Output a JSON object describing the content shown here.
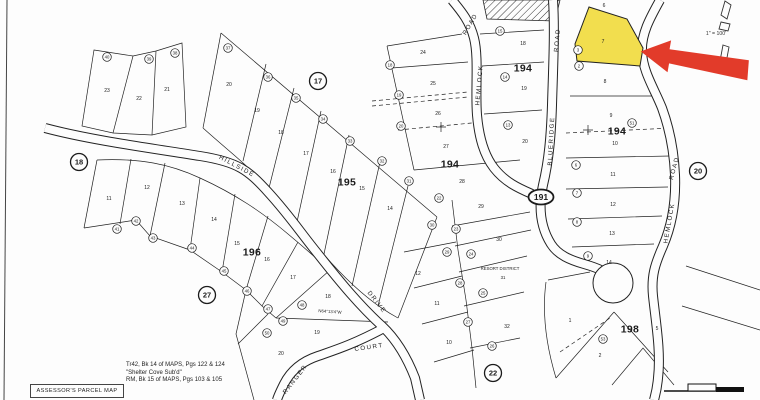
{
  "map": {
    "title": "ASSESSOR'S PARCEL MAP",
    "notes": [
      "Tr42, Bk 14 of MAPS, Pgs 122 & 124",
      "\"Shelter Cove Sub'd\"",
      "RM, Bk 15 of MAPS, Pgs 103 & 105"
    ],
    "scale_label": "1\" = 100'",
    "paper_color": "#fdfdfd",
    "ink_color": "#1b1b1b",
    "highlight": {
      "lot": "7",
      "fill": "#F2DE4E",
      "arrow_color": "#E23B2A"
    },
    "highway_shield": {
      "label": "191",
      "x": 541,
      "y": 197
    },
    "page_circles": [
      {
        "t": "17",
        "x": 318,
        "y": 81
      },
      {
        "t": "18",
        "x": 79,
        "y": 162
      },
      {
        "t": "27",
        "x": 207,
        "y": 295
      },
      {
        "t": "20",
        "x": 698,
        "y": 171
      },
      {
        "t": "22",
        "x": 493,
        "y": 373
      }
    ],
    "blocks": [
      {
        "t": "194",
        "x": 450,
        "y": 164
      },
      {
        "t": "194",
        "x": 523,
        "y": 68
      },
      {
        "t": "194",
        "x": 617,
        "y": 131
      },
      {
        "t": "195",
        "x": 347,
        "y": 182
      },
      {
        "t": "196",
        "x": 252,
        "y": 252
      },
      {
        "t": "198",
        "x": 630,
        "y": 329
      }
    ],
    "roads": [
      {
        "t": "HILLSIDE",
        "x": 237,
        "y": 166,
        "r": 28
      },
      {
        "t": "DRIVE",
        "x": 377,
        "y": 302,
        "r": 52
      },
      {
        "t": "COURT",
        "x": 369,
        "y": 347,
        "r": -8
      },
      {
        "t": "RANGER",
        "x": 295,
        "y": 379,
        "r": -52
      },
      {
        "t": "HEMLOCK",
        "x": 479,
        "y": 85,
        "r": -85
      },
      {
        "t": "ROAD",
        "x": 470,
        "y": 24,
        "r": -60
      },
      {
        "t": "BLUERIDGE",
        "x": 551,
        "y": 141,
        "r": -87
      },
      {
        "t": "ROAD",
        "x": 557,
        "y": 40,
        "r": -85
      },
      {
        "t": "HEMLOCK",
        "x": 669,
        "y": 223,
        "r": -80
      },
      {
        "t": "ROAD",
        "x": 674,
        "y": 168,
        "r": -75
      }
    ],
    "lots": [
      {
        "t": "23",
        "x": 107,
        "y": 90
      },
      {
        "t": "22",
        "x": 139,
        "y": 98
      },
      {
        "t": "21",
        "x": 167,
        "y": 89
      },
      {
        "t": "20",
        "x": 229,
        "y": 84
      },
      {
        "t": "19",
        "x": 257,
        "y": 110
      },
      {
        "t": "18",
        "x": 281,
        "y": 132
      },
      {
        "t": "17",
        "x": 306,
        "y": 153
      },
      {
        "t": "16",
        "x": 333,
        "y": 171
      },
      {
        "t": "15",
        "x": 362,
        "y": 188
      },
      {
        "t": "14",
        "x": 390,
        "y": 208
      },
      {
        "t": "11",
        "x": 109,
        "y": 198
      },
      {
        "t": "12",
        "x": 147,
        "y": 187
      },
      {
        "t": "13",
        "x": 182,
        "y": 203
      },
      {
        "t": "14",
        "x": 214,
        "y": 219
      },
      {
        "t": "15",
        "x": 237,
        "y": 243
      },
      {
        "t": "16",
        "x": 267,
        "y": 259
      },
      {
        "t": "17",
        "x": 293,
        "y": 277
      },
      {
        "t": "18",
        "x": 328,
        "y": 296
      },
      {
        "t": "19",
        "x": 317,
        "y": 332
      },
      {
        "t": "20",
        "x": 281,
        "y": 353
      },
      {
        "t": "24",
        "x": 423,
        "y": 52
      },
      {
        "t": "25",
        "x": 433,
        "y": 83
      },
      {
        "t": "26",
        "x": 438,
        "y": 113
      },
      {
        "t": "27",
        "x": 446,
        "y": 146
      },
      {
        "t": "28",
        "x": 462,
        "y": 181
      },
      {
        "t": "29",
        "x": 481,
        "y": 206
      },
      {
        "t": "30",
        "x": 499,
        "y": 239
      },
      {
        "t": "32",
        "x": 507,
        "y": 326
      },
      {
        "t": "12",
        "x": 418,
        "y": 273
      },
      {
        "t": "11",
        "x": 437,
        "y": 303
      },
      {
        "t": "10",
        "x": 449,
        "y": 342
      },
      {
        "t": "18",
        "x": 523,
        "y": 43
      },
      {
        "t": "19",
        "x": 524,
        "y": 88
      },
      {
        "t": "20",
        "x": 525,
        "y": 141
      },
      {
        "t": "6",
        "x": 604,
        "y": 5
      },
      {
        "t": "7",
        "x": 603,
        "y": 41
      },
      {
        "t": "8",
        "x": 605,
        "y": 81
      },
      {
        "t": "9",
        "x": 611,
        "y": 115
      },
      {
        "t": "10",
        "x": 615,
        "y": 143
      },
      {
        "t": "11",
        "x": 613,
        "y": 174
      },
      {
        "t": "12",
        "x": 613,
        "y": 204
      },
      {
        "t": "13",
        "x": 612,
        "y": 233
      },
      {
        "t": "14",
        "x": 609,
        "y": 262
      },
      {
        "t": "1",
        "x": 570,
        "y": 320
      },
      {
        "t": "2",
        "x": 600,
        "y": 355
      },
      {
        "t": "5",
        "x": 657,
        "y": 328
      }
    ],
    "parcel_circles": [
      {
        "t": "40",
        "x": 107,
        "y": 57
      },
      {
        "t": "39",
        "x": 149,
        "y": 59
      },
      {
        "t": "38",
        "x": 175,
        "y": 53
      },
      {
        "t": "37",
        "x": 228,
        "y": 48
      },
      {
        "t": "36",
        "x": 268,
        "y": 77
      },
      {
        "t": "35",
        "x": 296,
        "y": 98
      },
      {
        "t": "34",
        "x": 323,
        "y": 119
      },
      {
        "t": "33",
        "x": 350,
        "y": 141
      },
      {
        "t": "32",
        "x": 382,
        "y": 161
      },
      {
        "t": "31",
        "x": 409,
        "y": 181
      },
      {
        "t": "30",
        "x": 432,
        "y": 225
      },
      {
        "t": "41",
        "x": 117,
        "y": 229
      },
      {
        "t": "42",
        "x": 136,
        "y": 221
      },
      {
        "t": "43",
        "x": 153,
        "y": 238
      },
      {
        "t": "44",
        "x": 192,
        "y": 248
      },
      {
        "t": "45",
        "x": 224,
        "y": 271
      },
      {
        "t": "46",
        "x": 247,
        "y": 291
      },
      {
        "t": "47",
        "x": 268,
        "y": 309
      },
      {
        "t": "48",
        "x": 302,
        "y": 305
      },
      {
        "t": "49",
        "x": 283,
        "y": 321
      },
      {
        "t": "50",
        "x": 267,
        "y": 333
      },
      {
        "t": "18",
        "x": 390,
        "y": 65
      },
      {
        "t": "19",
        "x": 399,
        "y": 95
      },
      {
        "t": "20",
        "x": 401,
        "y": 126
      },
      {
        "t": "22",
        "x": 439,
        "y": 198
      },
      {
        "t": "23",
        "x": 456,
        "y": 229
      },
      {
        "t": "24",
        "x": 471,
        "y": 254
      },
      {
        "t": "29",
        "x": 447,
        "y": 252
      },
      {
        "t": "28",
        "x": 460,
        "y": 283
      },
      {
        "t": "25",
        "x": 483,
        "y": 293
      },
      {
        "t": "27",
        "x": 468,
        "y": 322
      },
      {
        "t": "26",
        "x": 492,
        "y": 346
      },
      {
        "t": "15",
        "x": 500,
        "y": 31
      },
      {
        "t": "14",
        "x": 505,
        "y": 77
      },
      {
        "t": "13",
        "x": 508,
        "y": 125
      },
      {
        "t": "3",
        "x": 578,
        "y": 50
      },
      {
        "t": "2",
        "x": 579,
        "y": 66
      },
      {
        "t": "51",
        "x": 632,
        "y": 123
      },
      {
        "t": "6",
        "x": 576,
        "y": 165
      },
      {
        "t": "7",
        "x": 577,
        "y": 193
      },
      {
        "t": "8",
        "x": 577,
        "y": 222
      },
      {
        "t": "9",
        "x": 588,
        "y": 256
      },
      {
        "t": "53",
        "x": 603,
        "y": 339
      }
    ],
    "resort_district": {
      "line1": "RESORT DISTRICT",
      "line2": "31",
      "x": 500,
      "y": 268
    },
    "bearing": {
      "text": "N64°13'4\"W",
      "x": 330,
      "y": 311,
      "rotate": 4
    }
  }
}
